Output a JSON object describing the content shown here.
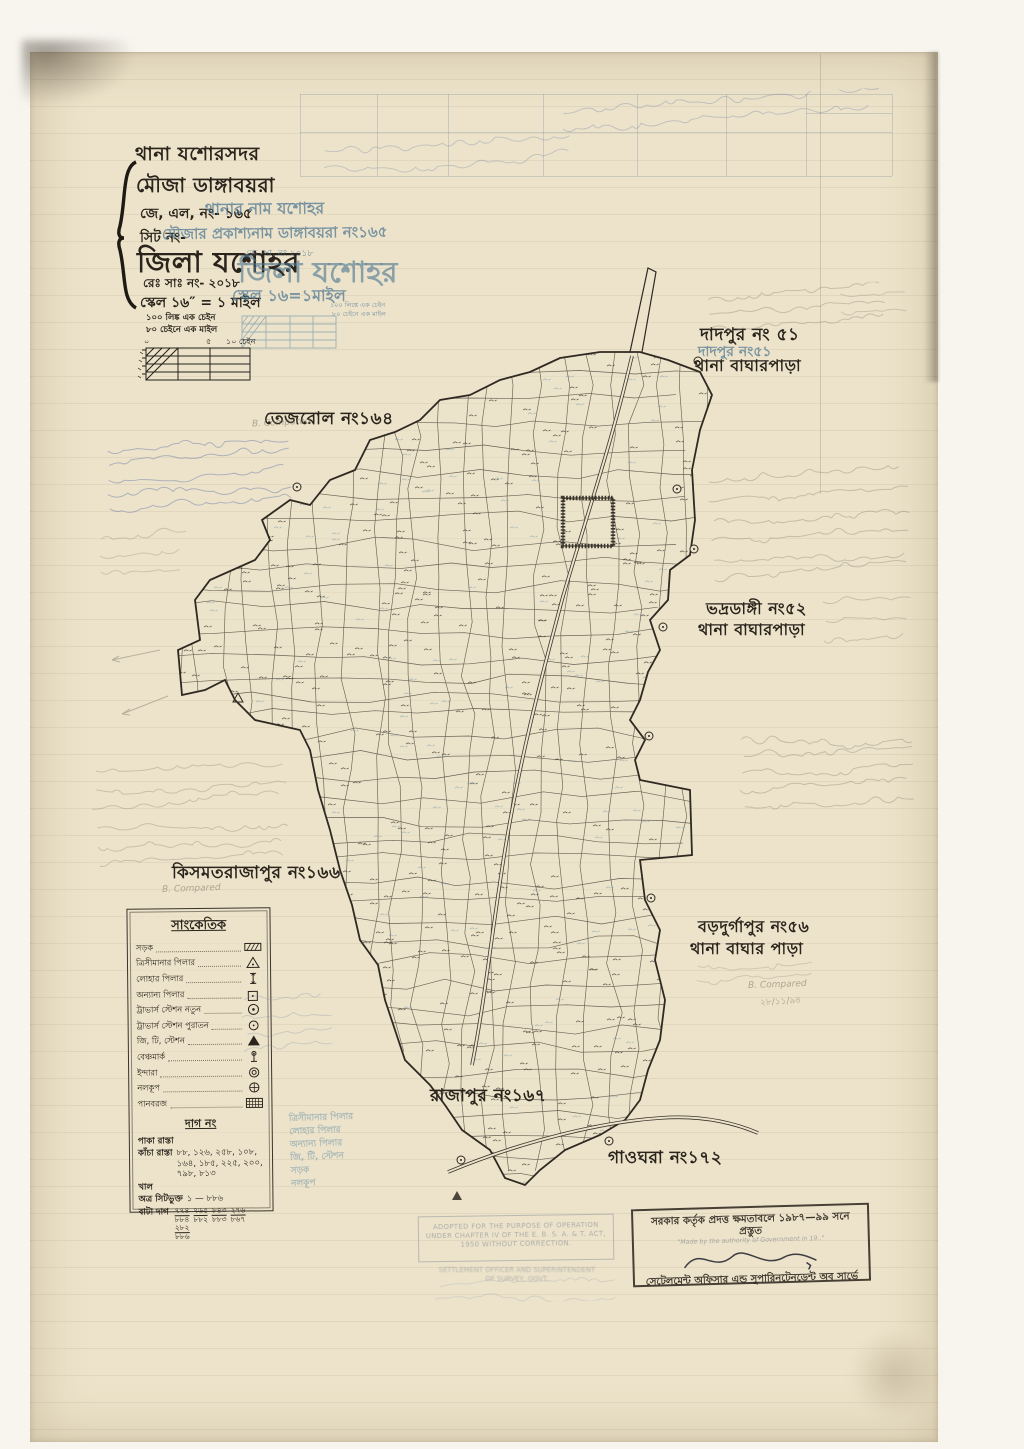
{
  "header": {
    "thana": "থানা  যশোরসদর",
    "mouza": "মৌজা ডাঙ্গাবয়রা",
    "jl_no": "জে, এল, নং- ১৬৫",
    "sheet_no": "সিট নং-",
    "district": "জিলা যশোহর",
    "reg_no": "রেঃ সাঃ নং- ২০১৮",
    "scale": "স্কেল ১৬″ = ১ মাইল"
  },
  "stamp_overlay": {
    "thana_name": "থানার নাম যশোহর",
    "mouza_name": "মৌজার প্রকাশ্যনাম ডাঙ্গাবয়রা নং১৬৫",
    "reg_no": "জে. সা. নং ২০১৮",
    "district": "জিলা যশোহর",
    "scale": "স্কেল ১৬=১মাইল",
    "note1": "১০০ লিঙ্কে এক চেইন",
    "note2": "৮০ চেইনে এক মাইল"
  },
  "scale_bar": {
    "note1": "১০০ লিঙ্ক এক চেইন",
    "note2": "৮০ চেইনে এক মাইল",
    "tick0": "০",
    "tick5": "৫",
    "tick10": "১০ চেইন"
  },
  "neighbors": [
    {
      "name": "দাদপুর নং ৫১",
      "stamp": "দাদপুর নং৫১",
      "thana": "থানা বাঘারপাড়া"
    },
    {
      "name": "তেজরোল নং১৬৪"
    },
    {
      "name": "ভদ্রডাঙ্গী নং৫২",
      "thana": "থানা বাঘারপাড়া"
    },
    {
      "name": "কিসমতরাজাপুর নং১৬৬"
    },
    {
      "name": "বড়দুর্গাপুর নং৫৬",
      "thana": "থানা বাঘার পাড়া"
    },
    {
      "name": "রাজাপুর নং১৬৭"
    },
    {
      "name": "গাওঘরা নং১৭২"
    }
  ],
  "legend": {
    "title": "সাংকেতিক",
    "items": [
      {
        "label": "সড়ক",
        "symbol": "hatched-bar"
      },
      {
        "label": "ত্রিসীমানার পিলার",
        "symbol": "triangle-outline"
      },
      {
        "label": "লোহার পিলার",
        "symbol": "iron-pillar"
      },
      {
        "label": "অন্যান্য পিলার",
        "symbol": "square-dot"
      },
      {
        "label": "ট্রাভার্স স্টেশন নতুন",
        "symbol": "circle-dot"
      },
      {
        "label": "ট্রাভার্স স্টেশন পুরাতন",
        "symbol": "circle-small-dot"
      },
      {
        "label": "জি, টি, স্টেশন",
        "symbol": "triangle-filled"
      },
      {
        "label": "বেঞ্চমার্ক",
        "symbol": "benchmark"
      },
      {
        "label": "ইন্দারা",
        "symbol": "double-circle"
      },
      {
        "label": "নলকূপ",
        "symbol": "circle-cross"
      },
      {
        "label": "পানবরজ",
        "symbol": "crosshatch-bar"
      }
    ],
    "dag_header": "দাগ নং",
    "dag_rows": [
      {
        "label": "পাকা রাস্তা",
        "value": ""
      },
      {
        "label": "কাঁচা রাস্তা",
        "value": "৮৮, ১২৬, ২৫৮, ১০৮, ১৬৪, ১৮৫, ২২৫, ২০০, ৭৯৮, ৮১৩"
      },
      {
        "label": "খাল",
        "value": ""
      },
      {
        "label": "অত্র সিটভুক্ত",
        "value": "১ — ৮৮৬"
      },
      {
        "label": "বাটা দাগ",
        "value": "৭৭৪/৮৮৪, ৭৬৫/৮৮২, ৮৪৩/৮৮৩, ২৭৬/৮৬৭, ২৮২/৮৮৬"
      }
    ]
  },
  "stamps": {
    "adopted": {
      "line1": "ADOPTED FOR THE PURPOSE OF OPERATION",
      "line2": "UNDER CHAPTER IV OF THE E. B. S. A. & T. ACT,",
      "line3": "1950 WITHOUT CORRECTION.",
      "extra1": "SETTLEMENT OFFICER AND SUPERINTENDENT",
      "extra2": "OF SURVEY, GOVT."
    },
    "authority": {
      "title": "সরকার কর্তৃক প্রদত্ত ক্ষমতাবলে ১৯৮৭—৯৯  সনে প্রস্তুত",
      "english": "\"Made by the authority of Government in 19..\"",
      "subtitle": "সেটেলমেন্ট অফিসার এন্ড সুপারিনটেনডেন্ট অব সার্ভে"
    }
  },
  "annotations": {
    "compared": "B. Compared",
    "date": "২৮/১১/৯৪"
  },
  "colors": {
    "paper": "#ece3ca",
    "ink": "#2b241c",
    "stamp_blue": "#5d87a3",
    "pencil": "#8f897c"
  }
}
